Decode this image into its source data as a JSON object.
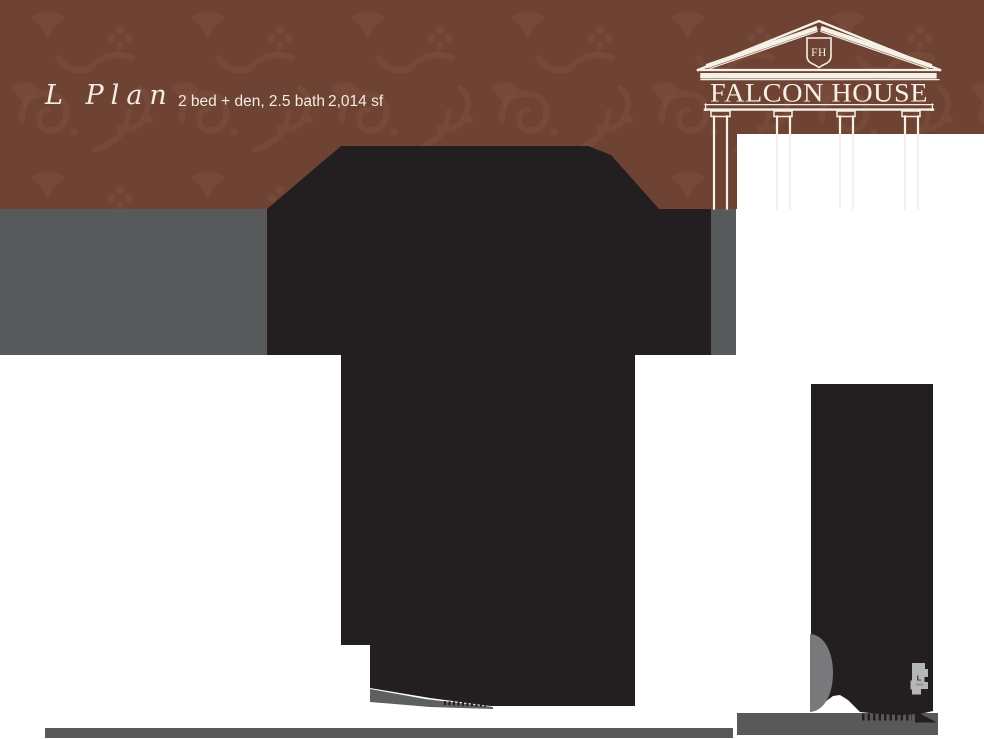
{
  "header": {
    "plan_name": "L Plan",
    "plan_specs": "2 bed + den, 2.5 bath",
    "plan_area": "2,014 sf"
  },
  "logo": {
    "wordmark": "FALCON HOUSE",
    "monogram": "FH"
  },
  "keyplan": {
    "label": "L"
  },
  "colors": {
    "header_brown": "#6e4333",
    "pattern_brown": "#7d4e3c",
    "band_gray": "#58595b",
    "bar_gray": "#58595b",
    "silhouette_black": "#231f20",
    "blob_gray": "#77797b",
    "wedge_gray": "#5e5f61",
    "keyplan_gray": "#b5b6b8",
    "keyplan_text": "#2b2b2c",
    "logo_cream": "#f6f1e7",
    "header_text_cream": "#f2ece2"
  }
}
